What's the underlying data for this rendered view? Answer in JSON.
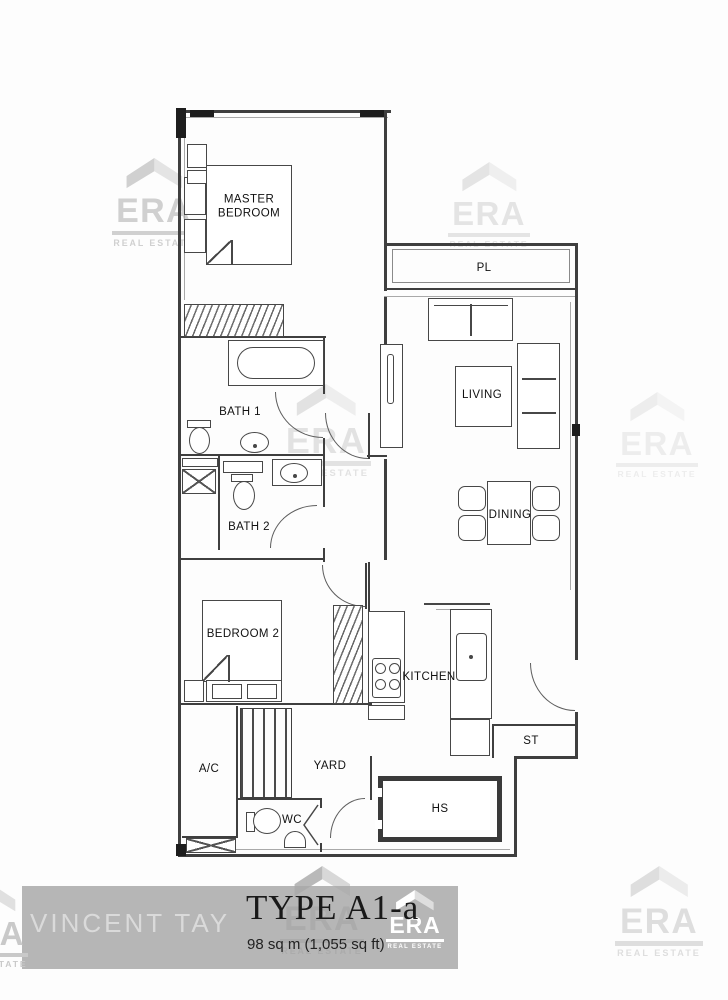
{
  "document": {
    "type_title": "TYPE A1-a",
    "area_text": "98 sq m (1,055 sq ft)",
    "agent_watermark": "VINCENT TAY"
  },
  "branding": {
    "era_label": "ERA",
    "era_sublabel": "REAL ESTATE"
  },
  "rooms": {
    "master_bedroom": "MASTER BEDROOM",
    "bath_1": "BATH 1",
    "bath_2": "BATH 2",
    "bedroom_2": "BEDROOM 2",
    "living": "LIVING",
    "dining": "DINING",
    "kitchen": "KITCHEN",
    "yard": "YARD",
    "ac_ledge": "A/C",
    "wc": "WC",
    "household_shelter": "HS",
    "store": "ST",
    "planter": "PL"
  },
  "colors": {
    "wall_line": "#3f3f3f",
    "band_background": "#b6b6b6",
    "watermark_gray": "#d2d2d2",
    "title_text": "#191919"
  }
}
